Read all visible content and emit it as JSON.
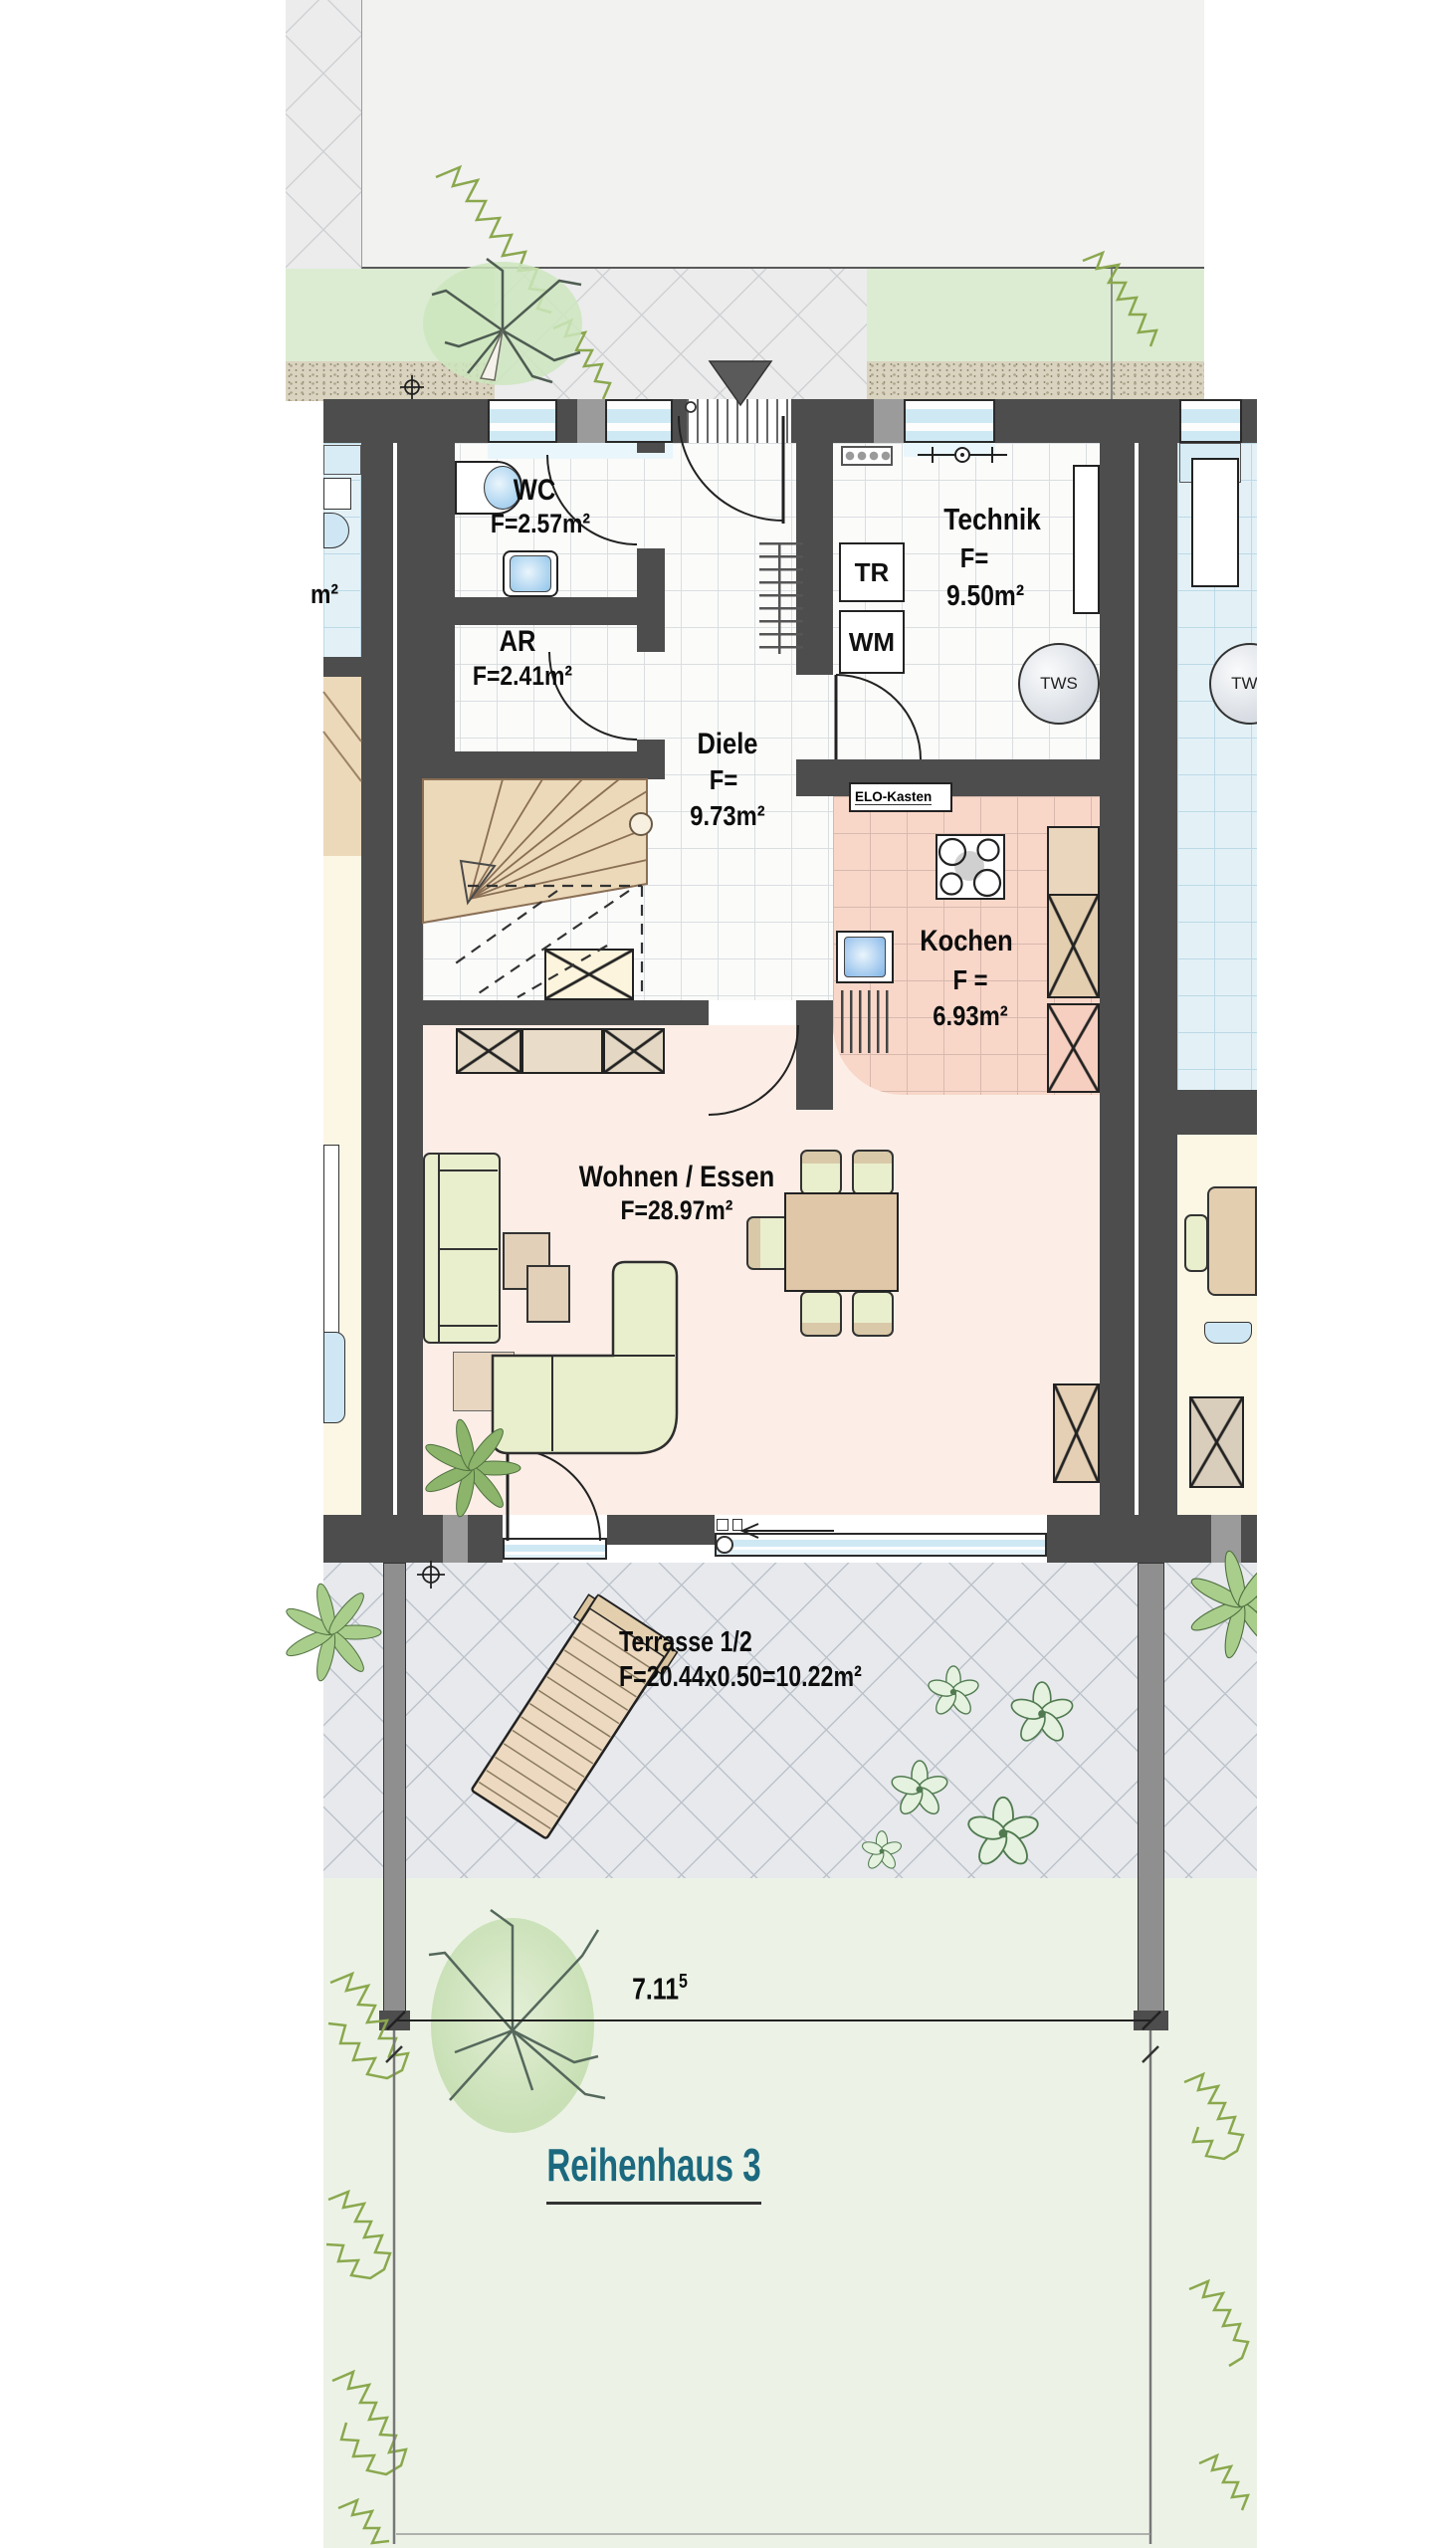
{
  "title": "Reihenhaus 3",
  "dimension": {
    "value": "7.11",
    "sup": "5"
  },
  "rooms": {
    "wc": {
      "name": "WC",
      "area": "F=2.57m²"
    },
    "ar": {
      "name": "AR",
      "area": "F=2.41m²"
    },
    "diele": {
      "name": "Diele",
      "area_prefix": "F=",
      "area_value": "9.73m²"
    },
    "technik": {
      "name": "Technik",
      "area_prefix": "F=",
      "area_value": "9.50m²"
    },
    "kochen": {
      "name": "Kochen",
      "area_prefix": "F =",
      "area_value": "6.93m²"
    },
    "wohnen": {
      "name": "Wohnen / Essen",
      "area": "F=28.97m²"
    },
    "terrasse": {
      "name": "Terrasse 1/2",
      "area": "F=20.44x0.50=10.22m²"
    }
  },
  "appliances": {
    "dryer": "TR",
    "washer": "WM",
    "water_heater_left": "TWS",
    "water_heater_right": "TWS",
    "electrical_box": "ELO-Kasten"
  },
  "neighbor": {
    "partial_area_label": "m²"
  },
  "colors": {
    "wall": "#4d4d4d",
    "wallLight": "#9b9b9b",
    "glass": "#cfe9f4",
    "blueFloor": "#e3f1f7",
    "kitchenFloor": "#f8d7c9",
    "livingFloor": "#fceee6",
    "paleFloor": "#fcf6e4",
    "stair": "#ecd9b9",
    "green": "#e9efcd",
    "beige": "#e3ceb0",
    "terrace": "#e7e9ed",
    "lawn": "#dcecd2",
    "garden": "#ecf3e6",
    "gravel": "#d9d3bf",
    "title": "#1c697f"
  }
}
